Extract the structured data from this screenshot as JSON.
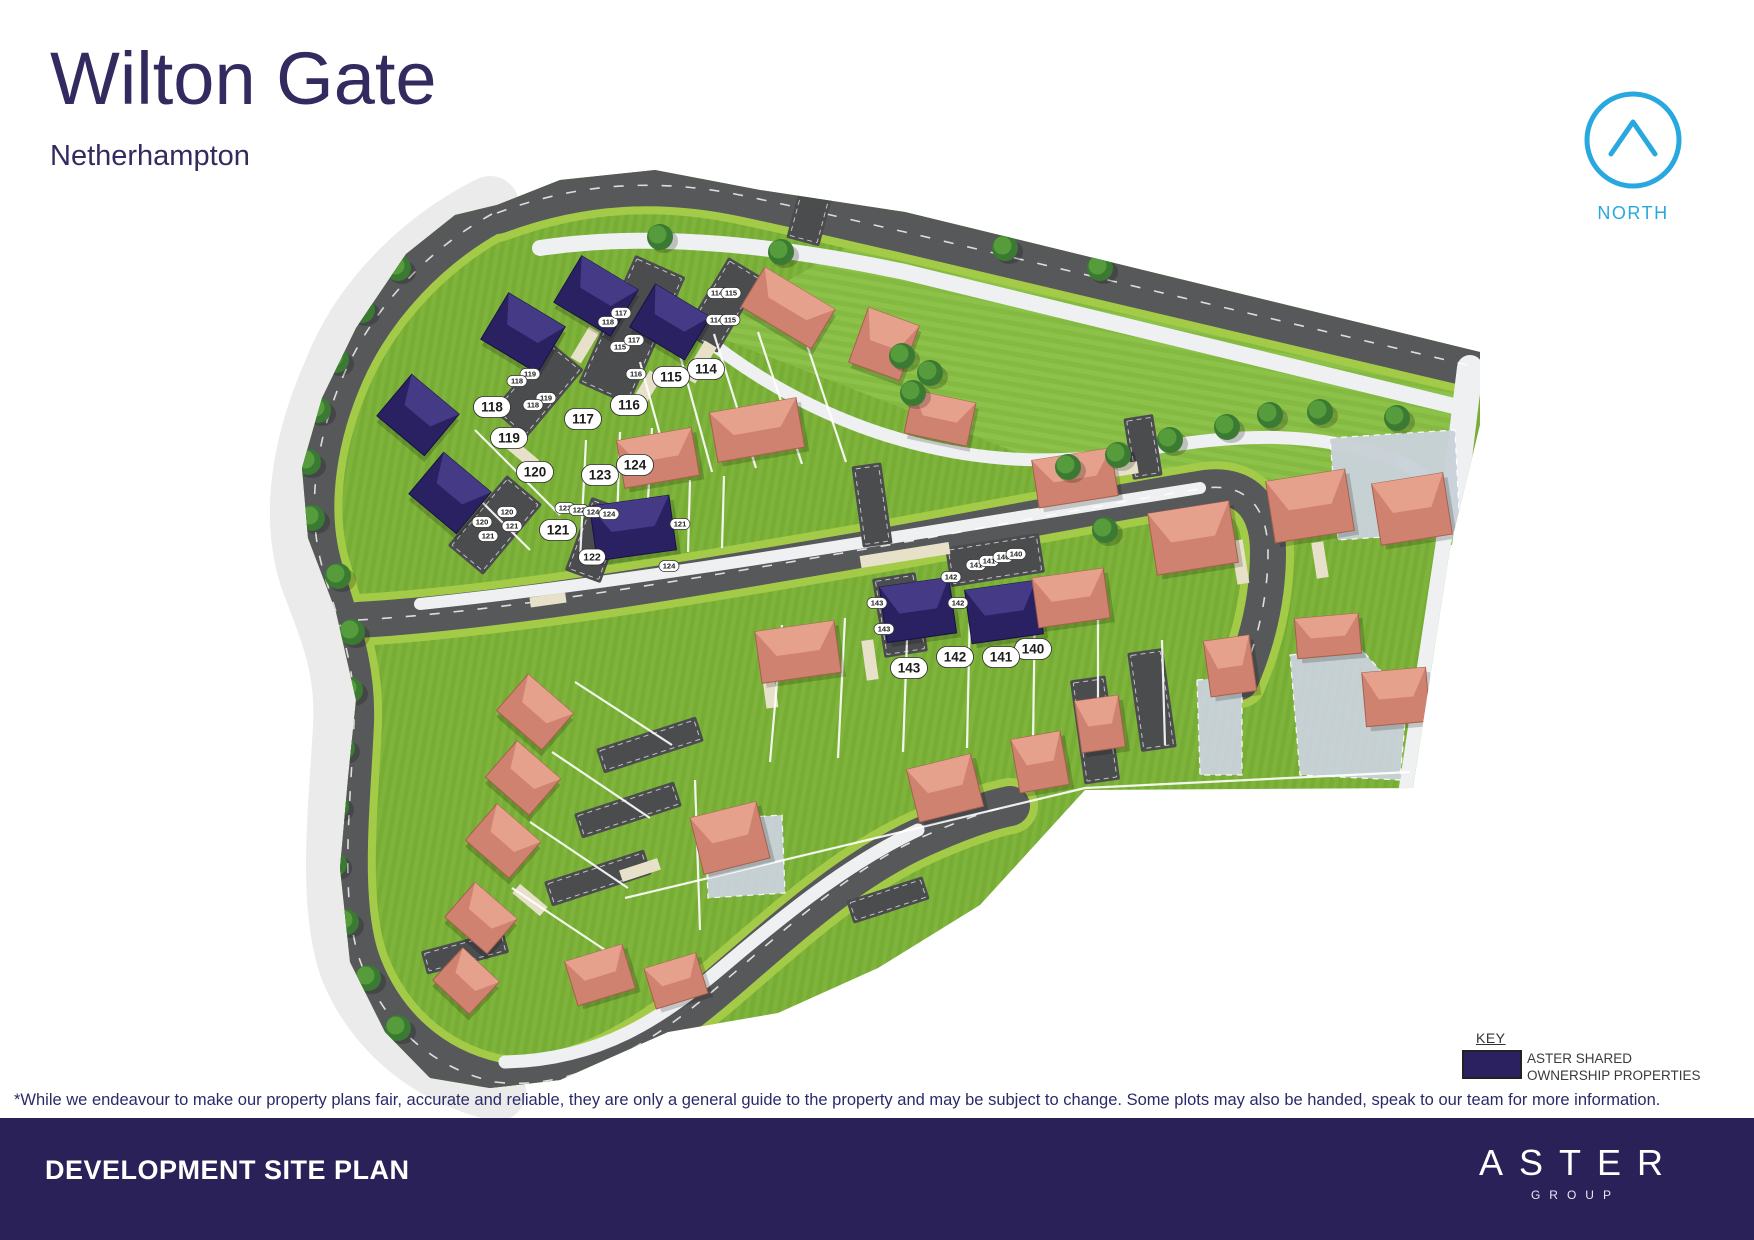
{
  "header": {
    "title": "Wilton Gate",
    "subtitle": "Netherhampton"
  },
  "north_label": "NORTH",
  "key": {
    "heading": "KEY",
    "label_line1": "ASTER SHARED",
    "label_line2": "OWNERSHIP PROPERTIES"
  },
  "disclaimer": "*While we endeavour to make our property plans fair, accurate and reliable, they are only a general guide to the property and may be subject to change. Some plots may also be handed, speak to our team for more information.",
  "footer": {
    "title": "DEVELOPMENT SITE PLAN",
    "brand": "ASTER",
    "brand_sub": "GROUP"
  },
  "colors": {
    "accent_blue": "#29a8e0",
    "brand_navy": "#2a2159",
    "shared_navy": "#2a2163",
    "shared_navy_light": "#443a86",
    "shared_navy_edge": "#171243",
    "roof_salmon": "#cf8270",
    "roof_salmon_light": "#e5a18c",
    "roof_salmon_edge": "#a95f4d",
    "road_grey": "#57585a",
    "parking_grey": "#4b4c4e",
    "court_grey": "#c9d2d8",
    "grass_a": "#7fb43c",
    "grass_b": "#76ab34",
    "grass_open": "#8cc14a",
    "verge": "#a4cb47",
    "path_light": "#eef0f1",
    "band": "#ebebec",
    "drive_beige": "#e8e1c9",
    "tree_dark": "#3a7a33",
    "tree_light": "#569b3c"
  },
  "map": {
    "plot_labels": [
      {
        "v": "114",
        "x": 706,
        "y": 369
      },
      {
        "v": "115",
        "x": 671,
        "y": 377
      },
      {
        "v": "116",
        "x": 629,
        "y": 405
      },
      {
        "v": "117",
        "x": 583,
        "y": 419
      },
      {
        "v": "118",
        "x": 492,
        "y": 407
      },
      {
        "v": "119",
        "x": 509,
        "y": 438
      },
      {
        "v": "120",
        "x": 535,
        "y": 472
      },
      {
        "v": "121",
        "x": 558,
        "y": 530
      },
      {
        "v": "122",
        "x": 592,
        "y": 557,
        "sm": 1
      },
      {
        "v": "123",
        "x": 600,
        "y": 475
      },
      {
        "v": "124",
        "x": 635,
        "y": 465
      },
      {
        "v": "140",
        "x": 1033,
        "y": 649
      },
      {
        "v": "141",
        "x": 1001,
        "y": 657
      },
      {
        "v": "142",
        "x": 955,
        "y": 657
      },
      {
        "v": "143",
        "x": 909,
        "y": 668
      }
    ],
    "parking_labels": [
      {
        "v": "118",
        "x": 608,
        "y": 322
      },
      {
        "v": "117",
        "x": 621,
        "y": 313
      },
      {
        "v": "115",
        "x": 620,
        "y": 347
      },
      {
        "v": "117",
        "x": 634,
        "y": 340
      },
      {
        "v": "116",
        "x": 636,
        "y": 374
      },
      {
        "v": "119",
        "x": 530,
        "y": 374
      },
      {
        "v": "118",
        "x": 517,
        "y": 381
      },
      {
        "v": "119",
        "x": 546,
        "y": 398
      },
      {
        "v": "118",
        "x": 533,
        "y": 405
      },
      {
        "v": "120",
        "x": 507,
        "y": 512
      },
      {
        "v": "121",
        "x": 512,
        "y": 526
      },
      {
        "v": "120",
        "x": 482,
        "y": 522
      },
      {
        "v": "121",
        "x": 488,
        "y": 536
      },
      {
        "v": "123",
        "x": 565,
        "y": 508
      },
      {
        "v": "122",
        "x": 579,
        "y": 510
      },
      {
        "v": "124",
        "x": 593,
        "y": 512
      },
      {
        "v": "124",
        "x": 609,
        "y": 514
      },
      {
        "v": "124",
        "x": 669,
        "y": 566
      },
      {
        "v": "121",
        "x": 680,
        "y": 524
      },
      {
        "v": "114",
        "x": 717,
        "y": 293
      },
      {
        "v": "115",
        "x": 731,
        "y": 293
      },
      {
        "v": "114",
        "x": 716,
        "y": 320
      },
      {
        "v": "115",
        "x": 730,
        "y": 320
      },
      {
        "v": "141",
        "x": 976,
        "y": 565
      },
      {
        "v": "141",
        "x": 989,
        "y": 561
      },
      {
        "v": "140",
        "x": 1003,
        "y": 557
      },
      {
        "v": "140",
        "x": 1016,
        "y": 554
      },
      {
        "v": "142",
        "x": 951,
        "y": 577
      },
      {
        "v": "142",
        "x": 958,
        "y": 603
      },
      {
        "v": "143",
        "x": 877,
        "y": 603
      },
      {
        "v": "143",
        "x": 884,
        "y": 629
      }
    ],
    "houses": [
      [
        523,
        333,
        66,
        54,
        31,
        "n"
      ],
      [
        596,
        296,
        66,
        54,
        31,
        "n"
      ],
      [
        670,
        322,
        64,
        50,
        31,
        "n"
      ],
      [
        418,
        415,
        62,
        54,
        40,
        "n"
      ],
      [
        450,
        493,
        62,
        54,
        40,
        "n"
      ],
      [
        633,
        528,
        80,
        55,
        -8,
        "n"
      ],
      [
        918,
        610,
        70,
        56,
        -8,
        "n"
      ],
      [
        1004,
        612,
        72,
        54,
        -8,
        "n"
      ],
      [
        788,
        308,
        82,
        46,
        31,
        "s"
      ],
      [
        884,
        344,
        54,
        58,
        20,
        "s"
      ],
      [
        940,
        418,
        64,
        44,
        12,
        "s"
      ],
      [
        658,
        458,
        76,
        48,
        -10,
        "s"
      ],
      [
        757,
        430,
        88,
        50,
        -10,
        "s"
      ],
      [
        1075,
        478,
        80,
        48,
        -9,
        "s"
      ],
      [
        1193,
        538,
        82,
        62,
        -9,
        "s"
      ],
      [
        1310,
        506,
        80,
        62,
        -9,
        "s"
      ],
      [
        1412,
        509,
        72,
        62,
        -9,
        "s"
      ],
      [
        798,
        652,
        80,
        52,
        -8,
        "s"
      ],
      [
        1071,
        598,
        72,
        50,
        -8,
        "s"
      ],
      [
        1230,
        666,
        46,
        56,
        -8,
        "s"
      ],
      [
        1328,
        636,
        64,
        40,
        -5,
        "s"
      ],
      [
        1396,
        697,
        64,
        54,
        -5,
        "s"
      ],
      [
        1100,
        724,
        44,
        52,
        -8,
        "s"
      ],
      [
        1040,
        762,
        50,
        54,
        -10,
        "s"
      ],
      [
        945,
        788,
        66,
        54,
        -14,
        "s"
      ],
      [
        730,
        838,
        68,
        58,
        -14,
        "s"
      ],
      [
        535,
        712,
        60,
        48,
        41,
        "s"
      ],
      [
        523,
        778,
        58,
        48,
        41,
        "s"
      ],
      [
        503,
        841,
        58,
        48,
        41,
        "s"
      ],
      [
        481,
        918,
        56,
        46,
        41,
        "s"
      ],
      [
        466,
        981,
        50,
        44,
        43,
        "s"
      ],
      [
        600,
        975,
        60,
        46,
        -17,
        "s"
      ],
      [
        676,
        981,
        54,
        42,
        -17,
        "s"
      ]
    ],
    "trees": [
      [
        398,
        268
      ],
      [
        362,
        310
      ],
      [
        336,
        360
      ],
      [
        318,
        410
      ],
      [
        308,
        462
      ],
      [
        312,
        518
      ],
      [
        338,
        576
      ],
      [
        352,
        632
      ],
      [
        350,
        690
      ],
      [
        342,
        748
      ],
      [
        336,
        806
      ],
      [
        334,
        864
      ],
      [
        346,
        922
      ],
      [
        368,
        978
      ],
      [
        398,
        1028
      ],
      [
        660,
        237
      ],
      [
        781,
        252
      ],
      [
        1005,
        248
      ],
      [
        1100,
        268
      ],
      [
        902,
        356
      ],
      [
        930,
        373
      ],
      [
        913,
        393
      ],
      [
        1068,
        467
      ],
      [
        1118,
        455
      ],
      [
        1170,
        440
      ],
      [
        1227,
        427
      ],
      [
        1270,
        415
      ],
      [
        1320,
        412
      ],
      [
        1397,
        418
      ],
      [
        1105,
        530
      ]
    ],
    "parking_areas": [
      [
        632,
        330,
        55,
        140,
        24
      ],
      [
        538,
        390,
        44,
        90,
        40
      ],
      [
        495,
        525,
        46,
        92,
        40
      ],
      [
        596,
        540,
        38,
        78,
        20
      ],
      [
        723,
        305,
        40,
        88,
        31
      ],
      [
        995,
        560,
        95,
        40,
        -9
      ],
      [
        900,
        615,
        44,
        80,
        -9
      ],
      [
        872,
        505,
        30,
        82,
        -8
      ],
      [
        1143,
        447,
        30,
        62,
        -9
      ],
      [
        650,
        745,
        105,
        26,
        -18
      ],
      [
        628,
        810,
        105,
        26,
        -18
      ],
      [
        598,
        878,
        105,
        26,
        -18
      ],
      [
        465,
        952,
        85,
        24,
        -15
      ],
      [
        888,
        900,
        80,
        24,
        -18
      ],
      [
        1152,
        700,
        36,
        100,
        -8
      ],
      [
        1095,
        730,
        36,
        105,
        -8
      ],
      [
        810,
        215,
        34,
        56,
        15
      ]
    ],
    "courts": [
      [
        [
          1330,
          438
        ],
        [
          1455,
          430
        ],
        [
          1460,
          532
        ],
        [
          1338,
          540
        ]
      ],
      [
        [
          1290,
          655
        ],
        [
          1360,
          648
        ],
        [
          1407,
          700
        ],
        [
          1400,
          780
        ],
        [
          1300,
          775
        ]
      ],
      [
        [
          705,
          820
        ],
        [
          782,
          815
        ],
        [
          785,
          893
        ],
        [
          708,
          898
        ]
      ],
      [
        [
          1197,
          680
        ],
        [
          1242,
          676
        ],
        [
          1242,
          775
        ],
        [
          1200,
          775
        ]
      ]
    ],
    "driveways": [
      [
        700,
        362,
        14,
        42,
        31
      ],
      [
        645,
        392,
        14,
        42,
        31
      ],
      [
        585,
        345,
        12,
        36,
        31
      ],
      [
        905,
        555,
        90,
        12,
        -9
      ],
      [
        1240,
        562,
        12,
        44,
        -9
      ],
      [
        1120,
        470,
        36,
        12,
        -9
      ],
      [
        520,
        452,
        40,
        12,
        40
      ],
      [
        548,
        600,
        36,
        10,
        -8
      ],
      [
        1320,
        560,
        12,
        36,
        -9
      ],
      [
        870,
        660,
        12,
        40,
        -8
      ],
      [
        770,
        690,
        12,
        36,
        -8
      ],
      [
        640,
        870,
        40,
        12,
        -18
      ],
      [
        530,
        900,
        36,
        12,
        40
      ]
    ]
  }
}
